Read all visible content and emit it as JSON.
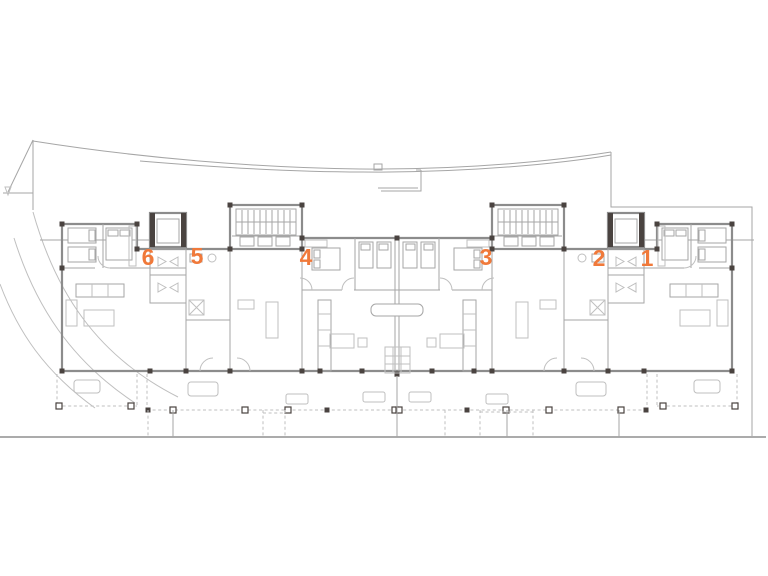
{
  "page": {
    "background": "#ffffff",
    "title": "Residential building ground floor plan"
  },
  "floor_plan": {
    "type": "architectural-floor-plan",
    "description": "Line-drawing floor plan of an apartment building with six numbered units, two stair cores, two elevators, front terraces and site boundary lines",
    "colors": {
      "accent": "#f0793a",
      "wall": "#8c8c8c",
      "thin_line": "#a6a6a6",
      "light_line": "#bfbfbf",
      "joint": "#4a4340",
      "background": "#ffffff"
    },
    "units": [
      {
        "label": "1",
        "x": 647,
        "y": 266
      },
      {
        "label": "2",
        "x": 599,
        "y": 266
      },
      {
        "label": "3",
        "x": 486,
        "y": 265
      },
      {
        "label": "4",
        "x": 306,
        "y": 265
      },
      {
        "label": "5",
        "x": 197,
        "y": 264
      },
      {
        "label": "6",
        "x": 148,
        "y": 265
      }
    ]
  }
}
